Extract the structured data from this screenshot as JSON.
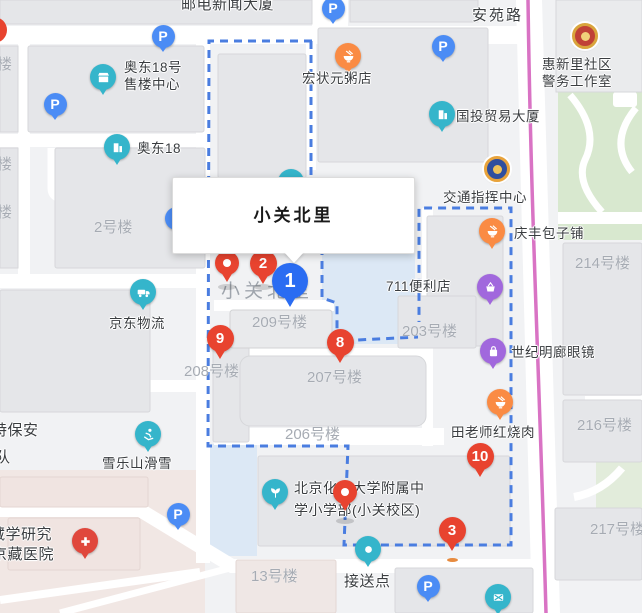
{
  "info_box": {
    "title": "小关北里"
  },
  "parking_glyph": "P",
  "pois": {
    "youdian_building": "邮电新闻大厦",
    "anyuan_road": "安苑路",
    "aodong_sales_line1": "奥东18号",
    "aodong_sales_line2": "售楼中心",
    "aodong18": "奥东18",
    "hongzhuangyuan": "宏状元粥店",
    "guotou": "国投贸易大厦",
    "huixinli_line1": "惠新里社区",
    "huixinli_line2": "警务工作室",
    "jiaotong_center": "交通指挥中心",
    "qingfeng": "庆丰包子铺",
    "store711": "711便利店",
    "shiji_glasses": "世纪明廊眼镜",
    "tianlaoshi": "田老师红烧肉",
    "jingdong": "京东物流",
    "xueleshan": "雪乐山滑雪",
    "school_line1": "北京化工大学附属中",
    "school_line2": "学小学部(小关校区)",
    "jiesongdian": "接送点",
    "tebaoan_line1": "特保安",
    "tebaoan_line2": "队",
    "zangxue": "藏学研究",
    "jingzang_hospital": "京藏医院"
  },
  "building_labels": {
    "lou_a": "楼",
    "lou_b": "楼",
    "lou_c": "楼",
    "b2": "2号楼",
    "xiaoguan_beili": "小关北里",
    "b209": "209号楼",
    "b203": "203号楼",
    "b208": "208号楼",
    "b207": "207号楼",
    "b206": "206号楼",
    "b214": "214号楼",
    "b216": "216号楼",
    "b217": "217号楼",
    "b13": "13号楼"
  },
  "markers": {
    "m1": "1",
    "m2": "2",
    "m3": "3",
    "m8": "8",
    "m9": "9",
    "m10": "10"
  }
}
